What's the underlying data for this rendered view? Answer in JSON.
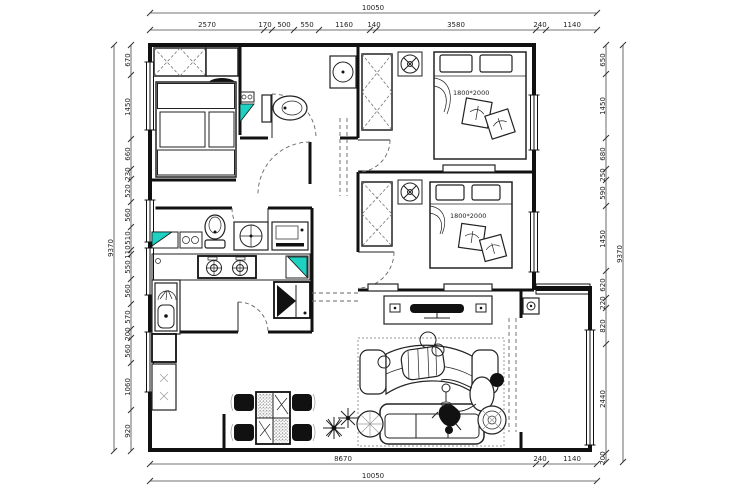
{
  "labels": {
    "bed1": "1800*2000",
    "bed2": "1800*2000"
  },
  "dims": {
    "top": {
      "total": "10050",
      "segments": [
        "2570",
        "170",
        "500",
        "550",
        "1160",
        "140",
        "3580",
        "240",
        "1140"
      ]
    },
    "bottom": {
      "total": "10050",
      "segments": [
        "8670",
        "240",
        "1140"
      ]
    },
    "left": {
      "total": "9370",
      "segments": [
        "670",
        "1450",
        "660",
        "230",
        "520",
        "560",
        "510",
        "110",
        "550",
        "560",
        "570",
        "200",
        "560",
        "1060",
        "920"
      ]
    },
    "right": {
      "total": "9370",
      "segments": [
        "650",
        "1450",
        "680",
        "250",
        "590",
        "1450",
        "620",
        "220",
        "820",
        "2440",
        "200"
      ]
    }
  },
  "colors": {
    "accent_teal": "#1fd1c0",
    "line": "#111111"
  }
}
